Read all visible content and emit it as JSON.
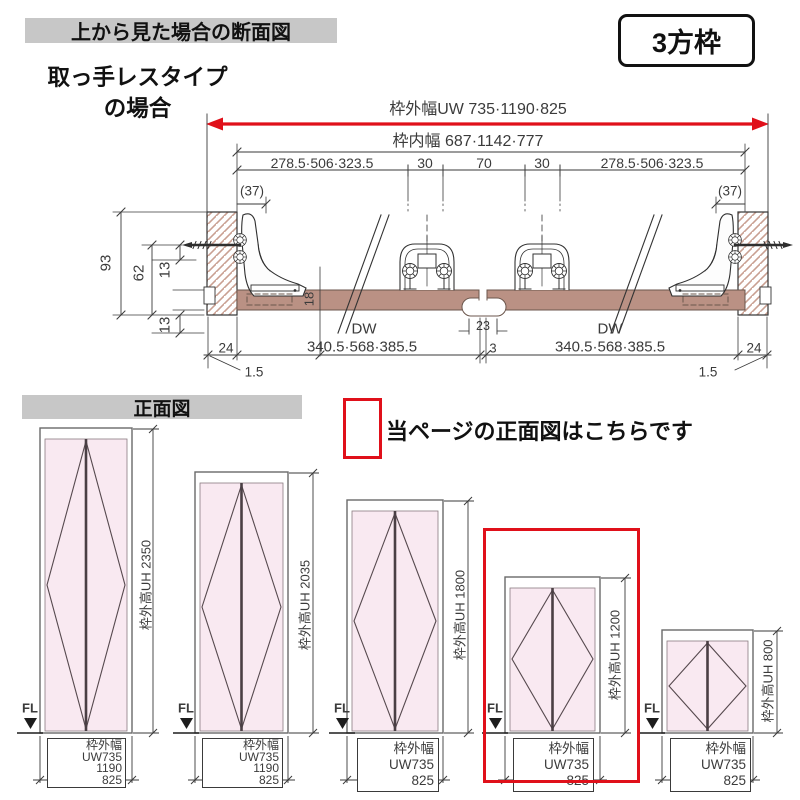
{
  "header": {
    "section_title": "上から見た場合の断面図",
    "frame_type_badge": "3方枠",
    "subtitle_line1": "取っ手レスタイプ",
    "subtitle_line2": "の場合"
  },
  "colors": {
    "accent_red": "#e0101a",
    "panel_brown": "#ba9184",
    "door_pink": "#f9e9f1",
    "header_gray": "#c7c7c7"
  },
  "cross_section": {
    "outer_width": "枠外幅UW 735·1190·825",
    "inner_width": "枠内幅  687·1142·777",
    "seg_left": "278.5·506·323.5",
    "seg_30a": "30",
    "seg_70": "70",
    "seg_30b": "30",
    "seg_right": "278.5·506·323.5",
    "paren_left": "(37)",
    "paren_right": "(37)",
    "dim_93": "93",
    "dim_62": "62",
    "dim_13_top": "13",
    "dim_13_bottom": "13",
    "dim_18": "18",
    "dw_label_left": "DW",
    "dw_value_left": "340.5·568·385.5",
    "dw_label_right": "DW",
    "dw_value_right": "340.5·568·385.5",
    "dim_23": "23",
    "dim_3": "3",
    "dim_24_left": "24",
    "dim_24_right": "24",
    "dim_1_5_left": "1.5",
    "dim_1_5_right": "1.5"
  },
  "front_view": {
    "title": "正面図",
    "note": "当ページの正面図はこちらです",
    "doors": [
      {
        "height_label": "枠外高UH 2350",
        "fl_label": "FL",
        "width_label_lines": [
          "枠外幅UW735",
          "1190",
          "825"
        ]
      },
      {
        "height_label": "枠外高UH 2035",
        "fl_label": "FL",
        "width_label_lines": [
          "枠外幅UW735",
          "1190",
          "825"
        ]
      },
      {
        "height_label": "枠外高UH 1800",
        "fl_label": "FL",
        "width_label_lines": [
          "枠外幅UW735",
          "825"
        ]
      },
      {
        "height_label": "枠外高UH 1200",
        "fl_label": "FL",
        "width_label_lines": [
          "枠外幅UW735",
          "825"
        ],
        "highlighted": true
      },
      {
        "height_label": "枠外高UH 800",
        "fl_label": "FL",
        "width_label_lines": [
          "枠外幅UW735",
          "825"
        ]
      }
    ]
  }
}
